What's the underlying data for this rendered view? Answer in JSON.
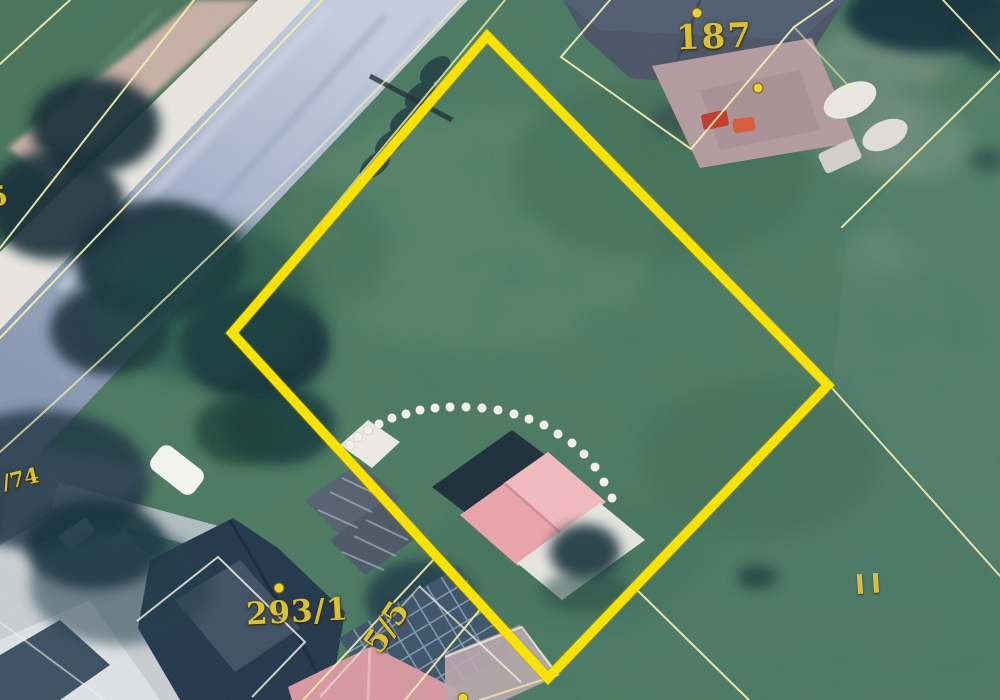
{
  "view": {
    "name": "aerial-cadastral-map",
    "description_visible_content_only": true
  },
  "labels": {
    "parcel_187": "187",
    "parcel_293_1": "293/1",
    "parcel_5_5": "5/5",
    "road_parcel_74": "/74",
    "edge_fragment": "5",
    "road_class_marker": "II"
  },
  "colors": {
    "selected_boundary": "#f7e203",
    "cadastral_line": "#f4eeb0",
    "parcel_label": "#d9c135",
    "grass_base": "#4e7a62",
    "road": "#a8b4cc",
    "house_roof_pink": "#e7a3a9"
  }
}
